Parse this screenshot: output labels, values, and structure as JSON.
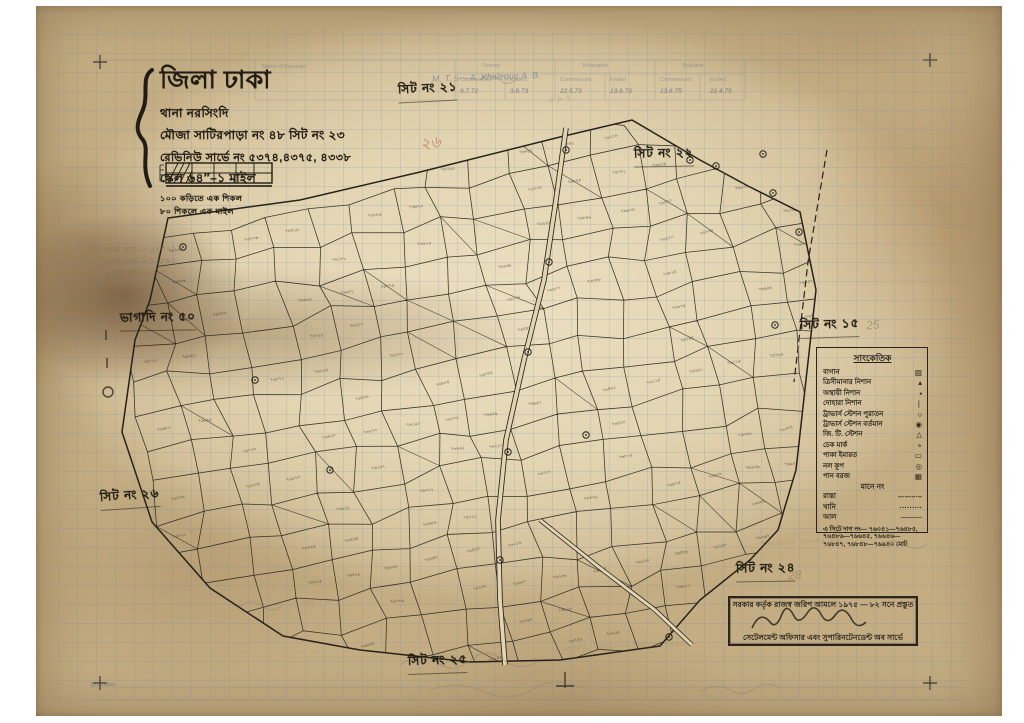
{
  "palette": {
    "ink": "#26221a",
    "pencil": "#8b7b63",
    "blue_pen": "#5a6f96",
    "red_pencil": "#b05a3a",
    "paper": "#e2d4b2"
  },
  "title_block": {
    "district": "জিলা ঢাকা",
    "thana": "থানা নরসিংদি",
    "mouza": "মৌজা সাটিরপাড়া নং ৪৮ সিট নং ২৩",
    "revenue": "রেভিনিউ সার্ভে নং ৫৩৭৪,৪৩৭৫, ৪৩৩৮",
    "scale": "স্কেল ৬৪″–১ মাইল",
    "links1": "১০০ কড়িতে এক শিকল",
    "links2": "৮০ শিকলে এক মাইল"
  },
  "sheet_labels": [
    {
      "text": "সিট নং ২১",
      "x": 398,
      "y": 80,
      "rot": -3
    },
    {
      "text": "সিট নং ২২",
      "x": 634,
      "y": 145,
      "rot": -1
    },
    {
      "text": "সিট নং ১৫",
      "x": 800,
      "y": 316,
      "rot": -2
    },
    {
      "text": "ভাগাদি নং ৫০",
      "x": 120,
      "y": 309,
      "rot": -1
    },
    {
      "text": "সিট নং ২৬",
      "x": 100,
      "y": 487,
      "rot": -4
    },
    {
      "text": "সিট নং ২৫",
      "x": 408,
      "y": 652,
      "rot": -2
    },
    {
      "text": "সিট নং ২৪",
      "x": 736,
      "y": 560,
      "rot": -1
    }
  ],
  "legend": {
    "title": "সাংকেতিক",
    "items": [
      {
        "label": "বাগান",
        "sym": "▨"
      },
      {
        "label": "ত্রিসীমানার নিশান",
        "sym": "▴"
      },
      {
        "label": "অস্থায়ী নিশান",
        "sym": "▪"
      },
      {
        "label": "দোহারা নিশান",
        "sym": "❘"
      },
      {
        "label": "ট্রাভার্স স্টেশন পুরাতন",
        "sym": "○"
      },
      {
        "label": "ট্রাভার্স স্টেশন বর্তমান",
        "sym": "◉"
      },
      {
        "label": "জি. টি. স্টেশন",
        "sym": "△"
      },
      {
        "label": "চেক মার্ক",
        "sym": "∘"
      },
      {
        "label": "পাকা ইমারত",
        "sym": "▭"
      },
      {
        "label": "নল কূপ",
        "sym": "◎"
      },
      {
        "label": "পান বরজ",
        "sym": "▦"
      }
    ],
    "mid_label": "মানে নং",
    "items2": [
      {
        "label": "রাস্তা",
        "sym": "–·–·–·–"
      },
      {
        "label": "খানি",
        "sym": "·········"
      },
      {
        "label": "আল",
        "sym": "────"
      }
    ],
    "note": "এ সিটে দাগ নং— ৭৬০৪১—৭৬৪৮৫, ৭৬৪৮৬—৭৬৬৪৫, ৭৬৬৪৬—৭৬৮৪৭, ৭৬৮৪৮—৭৬৯৪০ মোট"
  },
  "stamp": {
    "line1": "সরকার কর্তৃক রাজস্ব জরিপ আমলে ১৯৭৫ — ৮২ সনে প্রস্তুত",
    "line2": "সেটেলমেন্ট অফিসার এবং সুপারিনটেনডেন্ট অব সার্ভে"
  },
  "top_form": {
    "groups": [
      {
        "name": "Survey",
        "commenced": "9.7.72",
        "ended": "3.8.73"
      },
      {
        "name": "Khanapuri",
        "commenced": "22.5.73",
        "ended": "13.6.73"
      },
      {
        "name": "Bujharat",
        "commenced": "13.6.75",
        "ended": "21.4.75"
      }
    ],
    "subheads": [
      "Commenced",
      "Ended"
    ],
    "left_head": "Name of Kanungo"
  },
  "annotations": [
    {
      "text": "M. T. s—  A. Khaleque A. B.",
      "x": 432,
      "y": 72,
      "size": 9,
      "color": "#5a6f96",
      "opacity": 0.55,
      "rot": -2
    },
    {
      "text": "২৬",
      "x": 420,
      "y": 130,
      "size": 16,
      "color": "#b05a3a",
      "opacity": 0.6,
      "rot": -8
    },
    {
      "text": "25",
      "x": 866,
      "y": 318,
      "size": 12,
      "color": "#8b7b63",
      "opacity": 0.6,
      "rot": -6
    },
    {
      "text": "28",
      "x": 788,
      "y": 568,
      "size": 12,
      "color": "#8b7b63",
      "opacity": 0.6,
      "rot": -4
    },
    {
      "text": "পাকা কাগু — ১২৩০১",
      "x": 104,
      "y": 244,
      "size": 8,
      "color": "#7a6a52",
      "opacity": 0.65,
      "rot": -2
    },
    {
      "text": "মোট নোক — ১২৫৬১",
      "x": 104,
      "y": 256,
      "size": 8,
      "color": "#7a6a52",
      "opacity": 0.65,
      "rot": -2
    },
    {
      "text": "চূড়ান্ত যাঁচ — ৩৬৫",
      "x": 106,
      "y": 268,
      "size": 8,
      "color": "#7a6a52",
      "opacity": 0.6,
      "rot": -2
    },
    {
      "text": "৭৬৪৫৫ , ৭৬৪৯০ — ৭৬৫২০ , ৭৬৫৫০",
      "x": 560,
      "y": 640,
      "size": 8,
      "color": "#8b7b63",
      "opacity": 0.4,
      "rot": -2
    },
    {
      "text": "৭৬২৮৮ — ৭৬৩৪৫  মোট",
      "x": 760,
      "y": 536,
      "size": 8,
      "color": "#8b7b63",
      "opacity": 0.4,
      "rot": -3
    },
    {
      "text": "৩৫৮ । ৭১০",
      "x": 300,
      "y": 596,
      "size": 8,
      "color": "#8b7b63",
      "opacity": 0.35,
      "rot": -5
    },
    {
      "text": "২ ৮ ৭",
      "x": 548,
      "y": 92,
      "size": 9,
      "color": "#8b7b63",
      "opacity": 0.4,
      "rot": -4
    }
  ],
  "misc": {
    "chains_label": "10 Chains",
    "bn_digits": "০১২৩৪৫৬৭৮৯",
    "parcel_prefix_bn": "৭৬"
  },
  "map": {
    "seed": 11,
    "cell": {
      "w": 41,
      "h": 35,
      "angle": -10
    },
    "center": [
      468,
      395
    ],
    "label_ratio": 0.55,
    "diagonal_ratio": 0.16,
    "boundary": [
      [
        168,
        218
      ],
      [
        300,
        200
      ],
      [
        420,
        172
      ],
      [
        560,
        137
      ],
      [
        632,
        120
      ],
      [
        700,
        160
      ],
      [
        748,
        186
      ],
      [
        800,
        212
      ],
      [
        816,
        290
      ],
      [
        806,
        380
      ],
      [
        796,
        470
      ],
      [
        778,
        530
      ],
      [
        750,
        560
      ],
      [
        700,
        600
      ],
      [
        660,
        646
      ],
      [
        560,
        660
      ],
      [
        470,
        662
      ],
      [
        360,
        650
      ],
      [
        283,
        636
      ],
      [
        210,
        588
      ],
      [
        152,
        522
      ],
      [
        122,
        432
      ],
      [
        135,
        340
      ],
      [
        150,
        300
      ]
    ],
    "roads": {
      "main": [
        [
          566,
          128
        ],
        [
          556,
          200
        ],
        [
          544,
          280
        ],
        [
          524,
          360
        ],
        [
          506,
          440
        ],
        [
          498,
          520
        ],
        [
          500,
          600
        ],
        [
          505,
          665
        ]
      ],
      "branch": [
        [
          540,
          520
        ],
        [
          600,
          568
        ],
        [
          655,
          610
        ],
        [
          692,
          645
        ]
      ],
      "east_dashed": [
        [
          827,
          150
        ],
        [
          808,
          262
        ],
        [
          794,
          382
        ]
      ]
    },
    "stations": [
      [
        566,
        150
      ],
      [
        549,
        262
      ],
      [
        528,
        352
      ],
      [
        508,
        452
      ],
      [
        500,
        560
      ],
      [
        183,
        247
      ],
      [
        586,
        435
      ],
      [
        716,
        166
      ],
      [
        763,
        154
      ],
      [
        773,
        193
      ],
      [
        799,
        232
      ],
      [
        690,
        160
      ],
      [
        669,
        637
      ],
      [
        775,
        325
      ],
      [
        330,
        470
      ],
      [
        255,
        380
      ]
    ]
  }
}
